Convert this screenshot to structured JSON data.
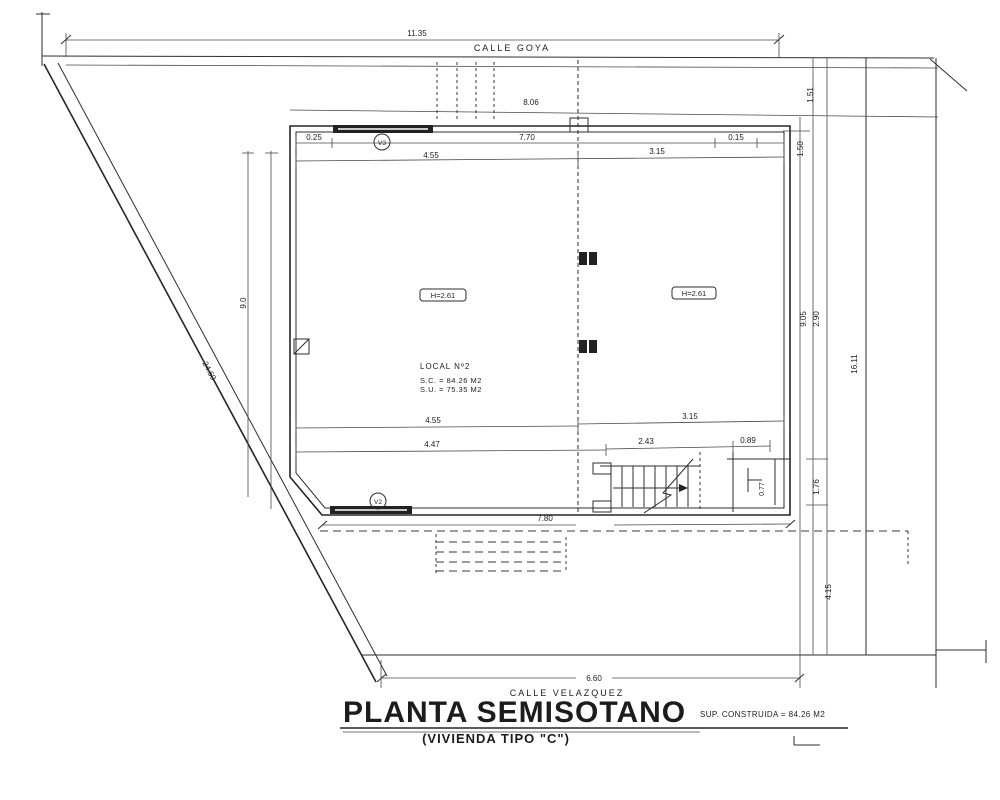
{
  "title": {
    "main": "PLANTA SEMISOTANO",
    "subtitle": "(VIVIENDA TIPO \"C\")",
    "note": "SUP. CONSTRUIDA = 84.26 M2"
  },
  "streets": {
    "top": "CALLE GOYA",
    "bottom": "CALLE VELAZQUEZ"
  },
  "room": {
    "name": "LOCAL Nº2",
    "built_area": "S.C. = 84.26 M2",
    "usable_area": "S.U. = 75.35 M2",
    "height_left": "H=2.61",
    "height_right": "H=2.61"
  },
  "windows": {
    "top": "V3",
    "bottom": "V2"
  },
  "dims": {
    "plot_top": "11.35",
    "setback": "8.06",
    "top_left_offset": "0.25",
    "top_span": "7.70",
    "top_right_offset": "0.15",
    "upper_left": "4.55",
    "upper_right": "3.15",
    "left_height": "9.0",
    "diagonal": "24.60",
    "right_top_a": "1.51",
    "right_top_b": "1.50",
    "right_mid_a": "9.05",
    "right_mid_b": "2.90",
    "plot_right": "16.11",
    "right_low": "1.76",
    "stair_right": "0.77",
    "right_lower": "4.15",
    "lower_left": "4.55",
    "lower_right": "3.15",
    "bottom_left": "4.47",
    "bottom_mid": "2.43",
    "bottom_right": "0.89",
    "bottom_wall": "7.80",
    "plot_bottom": "6.60"
  }
}
